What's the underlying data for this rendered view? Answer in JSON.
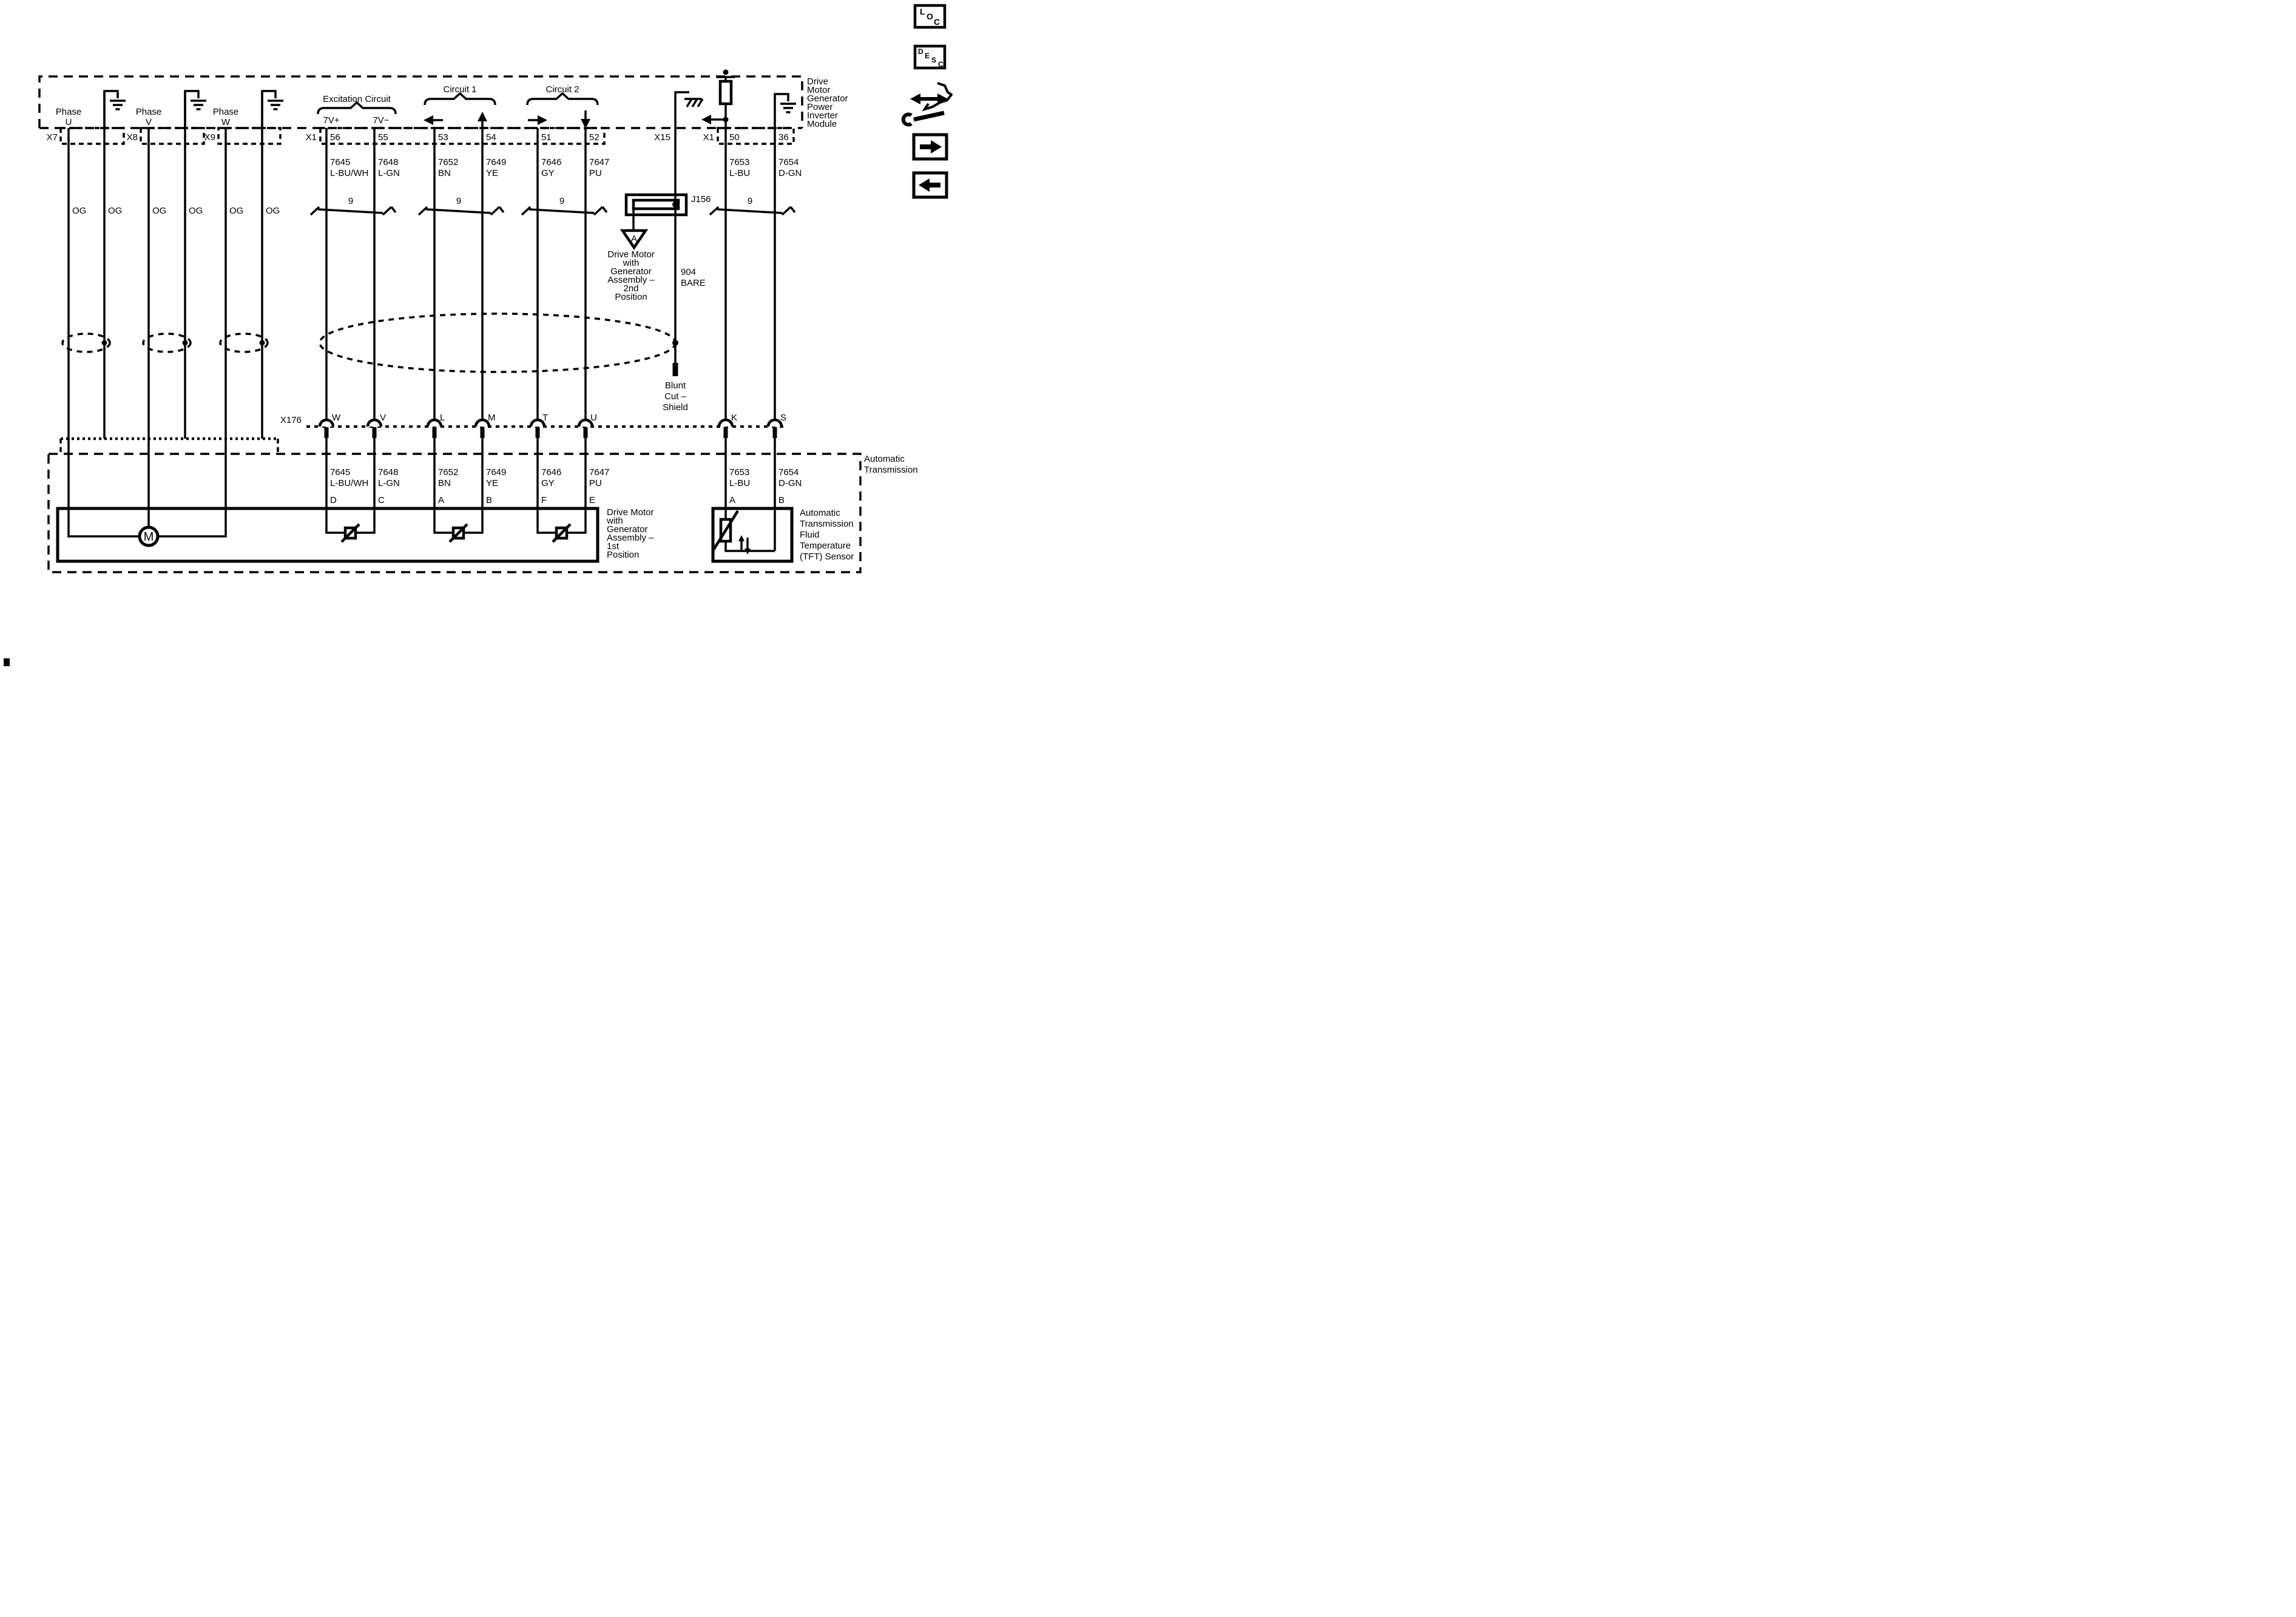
{
  "toolbar": {
    "loc": [
      "L",
      "O",
      "C"
    ],
    "desc": [
      "D",
      "E",
      "S",
      "C"
    ]
  },
  "module": {
    "label": [
      "Drive",
      "Motor",
      "Generator",
      "Power",
      "Inverter",
      "Module"
    ]
  },
  "transmission": {
    "label": [
      "Automatic",
      "Transmission"
    ]
  },
  "phases": [
    {
      "word": "Phase",
      "letter": "U",
      "connector": "X7",
      "wire_color": "OG",
      "drain_color": "OG"
    },
    {
      "word": "Phase",
      "letter": "V",
      "connector": "X8",
      "wire_color": "OG",
      "drain_color": "OG"
    },
    {
      "word": "Phase",
      "letter": "W",
      "connector": "X9",
      "wire_color": "OG",
      "drain_color": "OG"
    }
  ],
  "sections": {
    "excitation": {
      "title": "Excitation Circuit",
      "left_pin_label": "7V+",
      "right_pin_label": "7V−"
    },
    "circuit1": {
      "title": "Circuit 1"
    },
    "circuit2": {
      "title": "Circuit 2"
    }
  },
  "connectors": {
    "x1_top": "X1",
    "x15": "X15",
    "x1_right": "X1",
    "x176": "X176"
  },
  "harness_count": "9",
  "wires": [
    {
      "circuit": "7645",
      "color": "L-BU/WH",
      "pin": "56",
      "x176_pin": "W",
      "terminal": "D"
    },
    {
      "circuit": "7648",
      "color": "L-GN",
      "pin": "55",
      "x176_pin": "V",
      "terminal": "C"
    },
    {
      "circuit": "7652",
      "color": "BN",
      "pin": "53",
      "x176_pin": "L",
      "terminal": "A"
    },
    {
      "circuit": "7649",
      "color": "YE",
      "pin": "54",
      "x176_pin": "M",
      "terminal": "B"
    },
    {
      "circuit": "7646",
      "color": "GY",
      "pin": "51",
      "x176_pin": "T",
      "terminal": "F"
    },
    {
      "circuit": "7647",
      "color": "PU",
      "pin": "52",
      "x176_pin": "U",
      "terminal": "E"
    },
    {
      "circuit": "7653",
      "color": "L-BU",
      "pin": "50",
      "x176_pin": "K",
      "terminal": "A"
    },
    {
      "circuit": "7654",
      "color": "D-GN",
      "pin": "36",
      "x176_pin": "S",
      "terminal": "B"
    }
  ],
  "shield": {
    "circuit": "904",
    "color": "BARE",
    "blunt_label": [
      "Blunt",
      "Cut –",
      "Shield"
    ]
  },
  "splice": {
    "label": "J156"
  },
  "offpage": {
    "letter": "A",
    "label": [
      "Drive Motor",
      "with",
      "Generator",
      "Assembly –",
      "2nd",
      "Position"
    ]
  },
  "motor": {
    "letter": "M",
    "label": [
      "Drive Motor",
      "with",
      "Generator",
      "Assembly –",
      "1st",
      "Position"
    ]
  },
  "tft": {
    "label": [
      "Automatic",
      "Transmission",
      "Fluid",
      "Temperature",
      "(TFT) Sensor"
    ]
  }
}
